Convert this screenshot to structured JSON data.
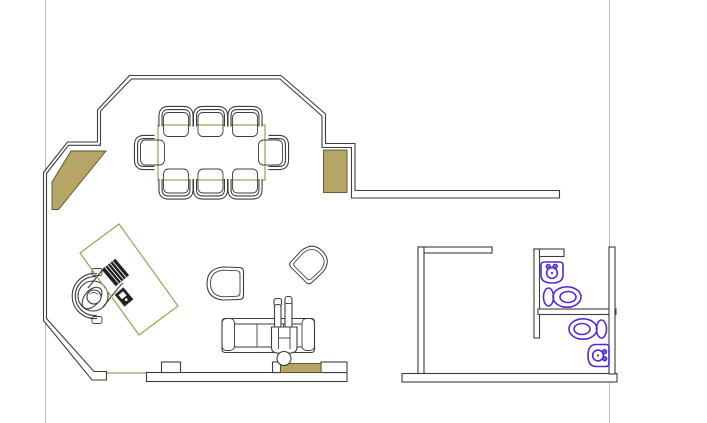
{
  "canvas": {
    "kind": "cad-floor-plan-drawing",
    "width": 707,
    "height": 423,
    "background": "#ffffff",
    "visible_text": ""
  },
  "colors": {
    "background": "#ffffff",
    "wall": "#3d3d3d",
    "tan": "#b5a567",
    "tan_outline": "#55502f",
    "tan_line": "#a99a55",
    "fixture": "#5527d8",
    "guide": "#bcbcbc",
    "dark": "#1f1f1f"
  },
  "inventory": {
    "page_guides": 2,
    "conference_table": 1,
    "conference_chairs": 8,
    "lounge_chairs": 2,
    "sofa": 1,
    "people_figures": 2,
    "desk": 1,
    "office_chair": 1,
    "keyboard": 1,
    "desk_phone": 1,
    "toilets": 2,
    "sinks": 2,
    "tan_door_openings": 4,
    "rooms": 3
  }
}
